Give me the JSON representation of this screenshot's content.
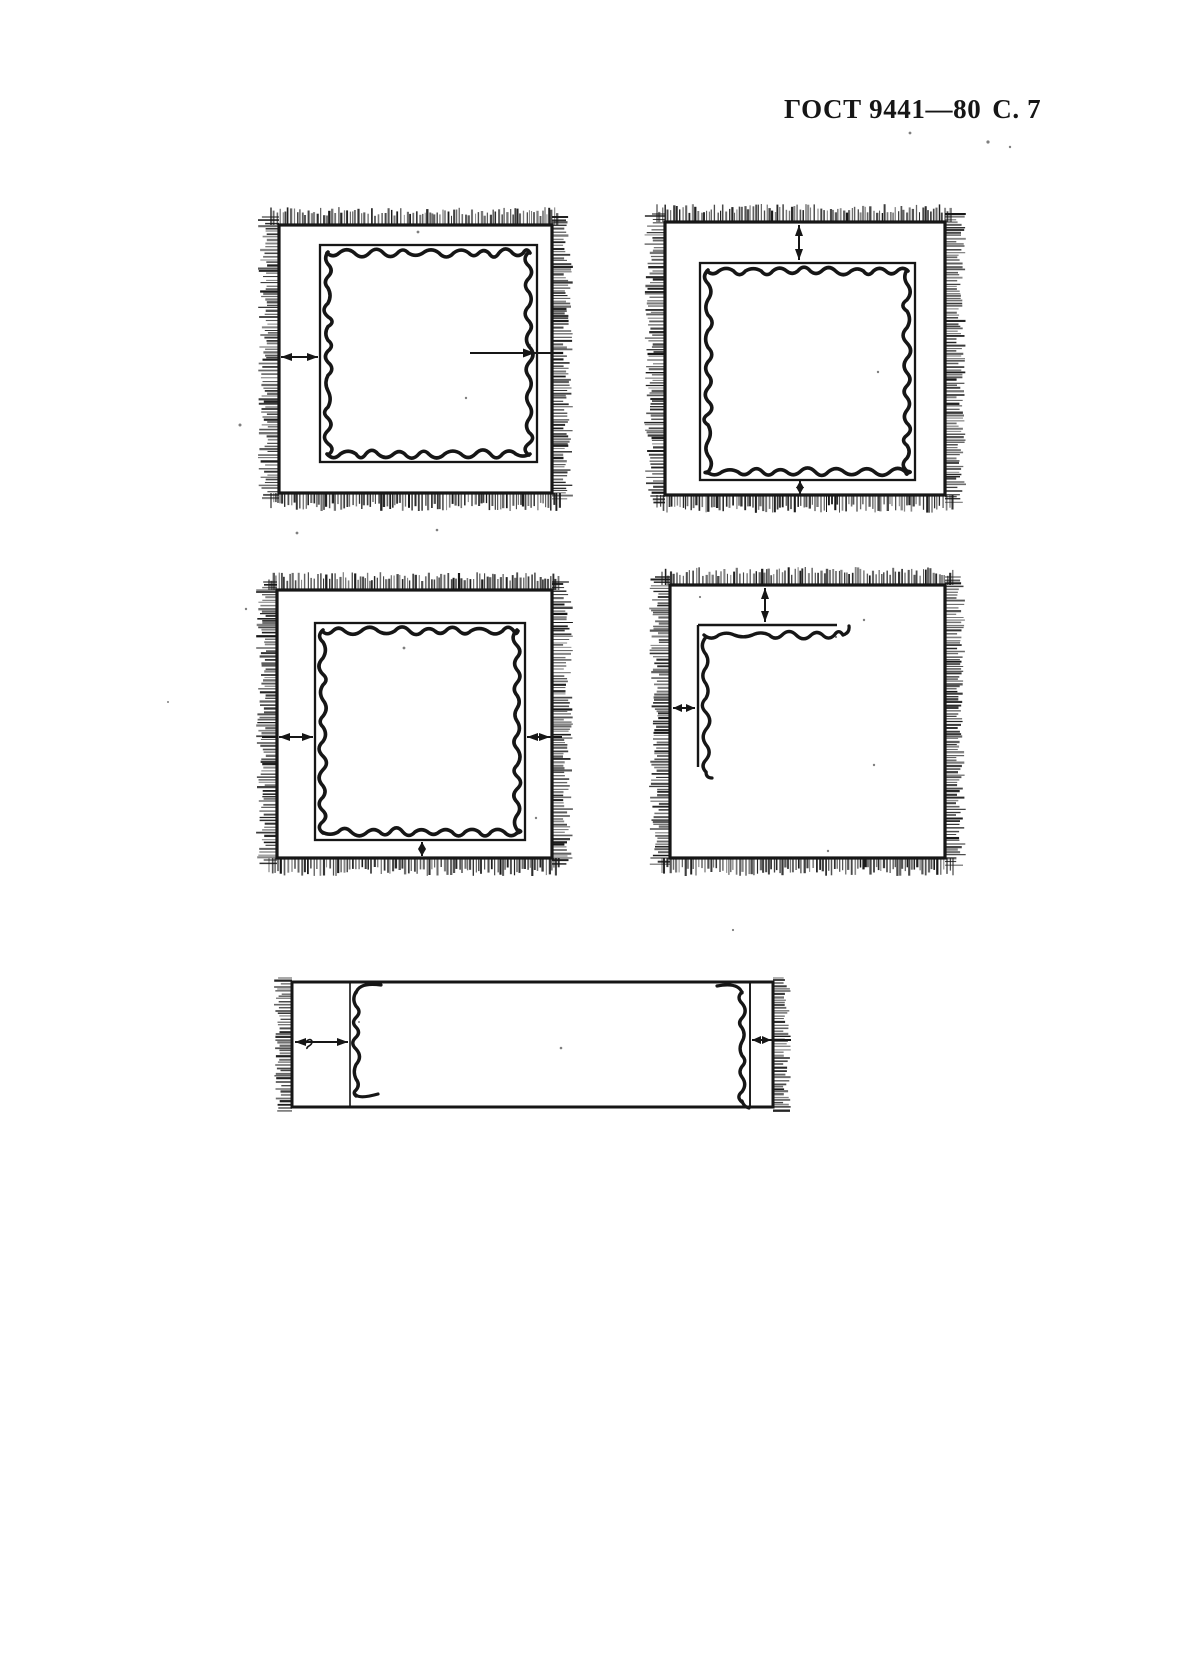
{
  "header": {
    "standard": "ГОСТ 9441—80",
    "page": "С. 7"
  },
  "colors": {
    "ink": "#161616",
    "paper": "#ffffff"
  },
  "figures": {
    "count": 5,
    "fig1": "fringed-square-stitched-frame-left-and-right-arrows",
    "fig2": "fringed-square-stitched-frame-top-and-bottom-arrows",
    "fig3": "fringed-square-stitched-frame-left-right-bottom-arrows",
    "fig4": "fringed-square-corner-stitch-top-and-left-arrows",
    "fig5": "fringed-strip-end-seams-left-and-right-arrows"
  }
}
